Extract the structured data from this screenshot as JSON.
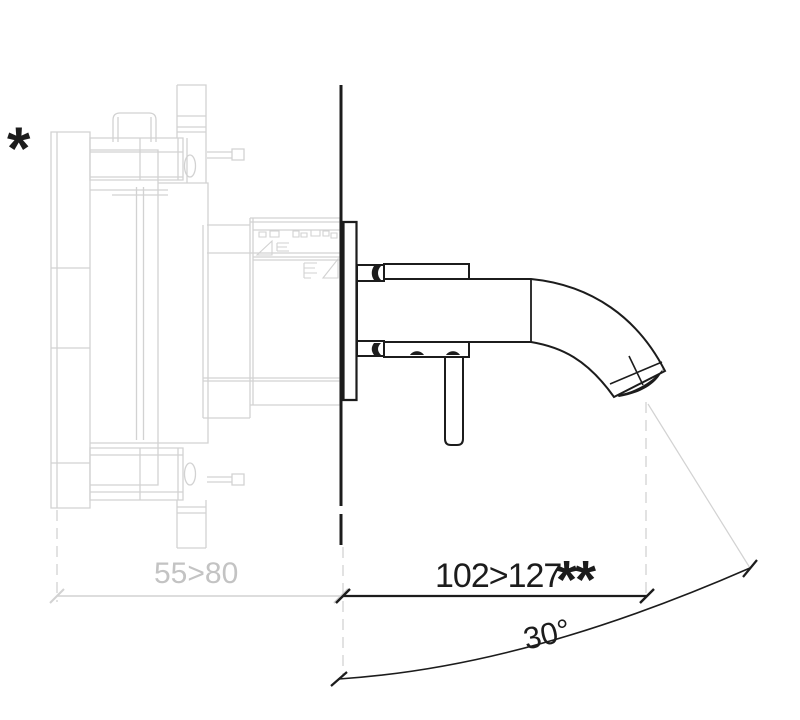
{
  "figure": {
    "type": "technical-line-drawing",
    "footnotes": {
      "star": "*",
      "double_star": "**"
    },
    "dimensions": {
      "wall_depth": {
        "label": "55>80"
      },
      "projection": {
        "label": "102>127",
        "suffix": "**"
      },
      "angle": {
        "label": "30°"
      }
    },
    "colors": {
      "background": "#ffffff",
      "line_black": "#1c1c1c",
      "line_gray": "#d2d2d2",
      "text_gray": "#c3c3c3",
      "text_black": "#1c1c1c"
    }
  }
}
